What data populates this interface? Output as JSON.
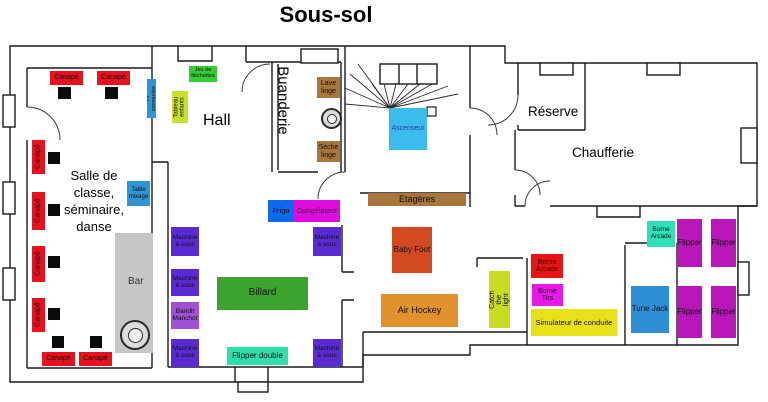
{
  "title": "Sous-sol",
  "rooms": {
    "classroom": "Salle de classe, séminaire, danse",
    "hall": "Hall",
    "laundry": "Buanderie",
    "reserve": "Réserve",
    "boiler": "Chaufferie",
    "bar": "Bar"
  },
  "colors": {
    "sofa": "#e8111e",
    "table": "#0b0b0b",
    "screen_blue": "#2e96d6",
    "board_green": "#ccde2e",
    "darts_green": "#35cc35",
    "wood_brown": "#a6763c",
    "elevator_cyan": "#3cbcee",
    "fridge_blue": "#0d6aef",
    "freezer_magenta": "#de0dde",
    "slot_violet": "#5a2bd5",
    "bandit_purple": "#a050d2",
    "billiard_green": "#3da32f",
    "teal_green": "#2edfac",
    "foosball_red": "#d2491f",
    "hockey_orange": "#e2922d",
    "arcade_red": "#e81414",
    "tirs_magenta": "#e818e8",
    "sim_yellow": "#e8e018",
    "tune_blue": "#2e8fd6",
    "pinball_purple": "#ba16ba",
    "bar_gray": "#c6c6c6"
  },
  "furniture": [
    {
      "n": "sofa",
      "l": "Canapé",
      "x": 50,
      "y": 71,
      "w": 33,
      "h": 14,
      "bg": "#e8111e"
    },
    {
      "n": "sofa",
      "l": "Canapé",
      "x": 97,
      "y": 71,
      "w": 33,
      "h": 14,
      "bg": "#e8111e"
    },
    {
      "n": "sofa",
      "l": "Canapé",
      "x": 32,
      "y": 140,
      "w": 13,
      "h": 34,
      "bg": "#e8111e",
      "v": true
    },
    {
      "n": "sofa",
      "l": "Canapé",
      "x": 32,
      "y": 192,
      "w": 13,
      "h": 38,
      "bg": "#e8111e",
      "v": true
    },
    {
      "n": "sofa",
      "l": "Canapé",
      "x": 32,
      "y": 246,
      "w": 13,
      "h": 36,
      "bg": "#e8111e",
      "v": true
    },
    {
      "n": "sofa",
      "l": "Canapé",
      "x": 32,
      "y": 298,
      "w": 13,
      "h": 34,
      "bg": "#e8111e",
      "v": true
    },
    {
      "n": "sofa",
      "l": "Canapé",
      "x": 42,
      "y": 352,
      "w": 33,
      "h": 14,
      "bg": "#e8111e"
    },
    {
      "n": "sofa",
      "l": "Canapé",
      "x": 79,
      "y": 352,
      "w": 33,
      "h": 14,
      "bg": "#e8111e"
    },
    {
      "n": "side-table",
      "l": "",
      "x": 58,
      "y": 87,
      "w": 13,
      "h": 12,
      "bg": "#0b0b0b"
    },
    {
      "n": "side-table",
      "l": "",
      "x": 105,
      "y": 87,
      "w": 13,
      "h": 12,
      "bg": "#0b0b0b"
    },
    {
      "n": "side-table",
      "l": "",
      "x": 48,
      "y": 152,
      "w": 12,
      "h": 12,
      "bg": "#0b0b0b"
    },
    {
      "n": "side-table",
      "l": "",
      "x": 48,
      "y": 204,
      "w": 12,
      "h": 12,
      "bg": "#0b0b0b"
    },
    {
      "n": "side-table",
      "l": "",
      "x": 48,
      "y": 256,
      "w": 12,
      "h": 12,
      "bg": "#0b0b0b"
    },
    {
      "n": "side-table",
      "l": "",
      "x": 48,
      "y": 308,
      "w": 12,
      "h": 12,
      "bg": "#0b0b0b"
    },
    {
      "n": "side-table",
      "l": "",
      "x": 52,
      "y": 336,
      "w": 12,
      "h": 12,
      "bg": "#0b0b0b"
    },
    {
      "n": "side-table",
      "l": "",
      "x": 90,
      "y": 336,
      "w": 12,
      "h": 12,
      "bg": "#0b0b0b"
    },
    {
      "n": "connected-tv",
      "l": "TV connectée",
      "x": 147,
      "y": 79,
      "w": 9,
      "h": 39,
      "bg": "#2e96d6",
      "v": true,
      "fs": 5.5
    },
    {
      "n": "kids-board",
      "l": "Tableau enfants",
      "x": 172,
      "y": 91,
      "w": 16,
      "h": 32,
      "bg": "#ccde2e",
      "v": true,
      "fs": 6
    },
    {
      "n": "darts-game",
      "l": "Jeu de fléchettes",
      "x": 189,
      "y": 66,
      "w": 28,
      "h": 16,
      "bg": "#35cc35",
      "fs": 5.5
    },
    {
      "n": "mixing-table",
      "l": "Table mixage",
      "x": 127,
      "y": 181,
      "w": 23,
      "h": 25,
      "bg": "#2e96d6",
      "fs": 6
    },
    {
      "n": "washing-machine",
      "l": "Lave linge",
      "x": 317,
      "y": 77,
      "w": 23,
      "h": 21,
      "bg": "#a6763c",
      "fs": 7
    },
    {
      "n": "dryer",
      "l": "Sèche linge",
      "x": 317,
      "y": 141,
      "w": 23,
      "h": 21,
      "bg": "#a6763c",
      "fs": 7
    },
    {
      "n": "elevator",
      "l": "Ascenseur",
      "x": 389,
      "y": 108,
      "w": 38,
      "h": 42,
      "bg": "#3cbcee",
      "fs": 7,
      "c": "#1a3fae"
    },
    {
      "n": "shelves",
      "l": "Etagères",
      "x": 368,
      "y": 193,
      "w": 98,
      "h": 13,
      "bg": "#a6763c",
      "fs": 9
    },
    {
      "n": "fridge",
      "l": "Frigo",
      "x": 268,
      "y": 200,
      "w": 26,
      "h": 22,
      "bg": "#0d6aef",
      "fs": 7.5
    },
    {
      "n": "freezer",
      "l": "Congélateur",
      "x": 294,
      "y": 200,
      "w": 46,
      "h": 22,
      "bg": "#de0dde",
      "fs": 7.5
    },
    {
      "n": "slot-machine",
      "l": "Machine à sous",
      "x": 171,
      "y": 227,
      "w": 28,
      "h": 29,
      "bg": "#5a2bd5",
      "fs": 6.5
    },
    {
      "n": "slot-machine",
      "l": "Machine à sous",
      "x": 171,
      "y": 269,
      "w": 28,
      "h": 27,
      "bg": "#5a2bd5",
      "fs": 6.5
    },
    {
      "n": "one-armed-bandit",
      "l": "Bandit Manchot",
      "x": 171,
      "y": 302,
      "w": 28,
      "h": 27,
      "bg": "#a050d2",
      "fs": 6.5
    },
    {
      "n": "slot-machine",
      "l": "Machine à sous",
      "x": 171,
      "y": 339,
      "w": 28,
      "h": 28,
      "bg": "#5a2bd5",
      "fs": 6.5
    },
    {
      "n": "slot-machine",
      "l": "Machine à sous",
      "x": 313,
      "y": 227,
      "w": 28,
      "h": 29,
      "bg": "#5a2bd5",
      "fs": 6.5
    },
    {
      "n": "slot-machine",
      "l": "Machine à sous",
      "x": 313,
      "y": 339,
      "w": 28,
      "h": 28,
      "bg": "#5a2bd5",
      "fs": 6.5
    },
    {
      "n": "billiard-table",
      "l": "Billard",
      "x": 217,
      "y": 277,
      "w": 91,
      "h": 33,
      "bg": "#3da32f",
      "fs": 10
    },
    {
      "n": "double-pinball",
      "l": "Flipper double",
      "x": 227,
      "y": 347,
      "w": 61,
      "h": 18,
      "bg": "#2edfac",
      "fs": 8
    },
    {
      "n": "foosball",
      "l": "Baby Foot",
      "x": 392,
      "y": 227,
      "w": 40,
      "h": 46,
      "bg": "#d2491f",
      "fs": 8
    },
    {
      "n": "air-hockey",
      "l": "Air Hockey",
      "x": 381,
      "y": 294,
      "w": 77,
      "h": 33,
      "bg": "#e2922d",
      "fs": 9
    },
    {
      "n": "catch-the-light",
      "l": "Catch the light",
      "x": 489,
      "y": 271,
      "w": 21,
      "h": 57,
      "bg": "#c7dc23",
      "v": true,
      "fs": 7
    },
    {
      "n": "arcade-cabinet",
      "l": "Borne Arcade",
      "x": 531,
      "y": 254,
      "w": 32,
      "h": 24,
      "bg": "#e81414",
      "fs": 7
    },
    {
      "n": "shooting-cabinet",
      "l": "Borne Tirs",
      "x": 532,
      "y": 284,
      "w": 31,
      "h": 22,
      "bg": "#e818e8",
      "fs": 7
    },
    {
      "n": "driving-simulator",
      "l": "Simulateur de conduite",
      "x": 531,
      "y": 309,
      "w": 86,
      "h": 27,
      "bg": "#e8e018",
      "fs": 7.5
    },
    {
      "n": "tune-jack",
      "l": "Tune Jack",
      "x": 631,
      "y": 286,
      "w": 38,
      "h": 47,
      "bg": "#2e8fd6",
      "fs": 8
    },
    {
      "n": "arcade-cabinet",
      "l": "Borne Arcade",
      "x": 647,
      "y": 221,
      "w": 28,
      "h": 26,
      "bg": "#2edfb8",
      "fs": 6.5
    },
    {
      "n": "pinball",
      "l": "Flipper",
      "x": 677,
      "y": 219,
      "w": 25,
      "h": 48,
      "bg": "#ba16ba",
      "fs": 8
    },
    {
      "n": "pinball",
      "l": "Flipper",
      "x": 711,
      "y": 219,
      "w": 25,
      "h": 48,
      "bg": "#ba16ba",
      "fs": 8
    },
    {
      "n": "pinball",
      "l": "Flipper",
      "x": 677,
      "y": 286,
      "w": 25,
      "h": 52,
      "bg": "#ba16ba",
      "fs": 8
    },
    {
      "n": "pinball",
      "l": "Flipper",
      "x": 711,
      "y": 286,
      "w": 25,
      "h": 52,
      "bg": "#ba16ba",
      "fs": 8
    }
  ]
}
